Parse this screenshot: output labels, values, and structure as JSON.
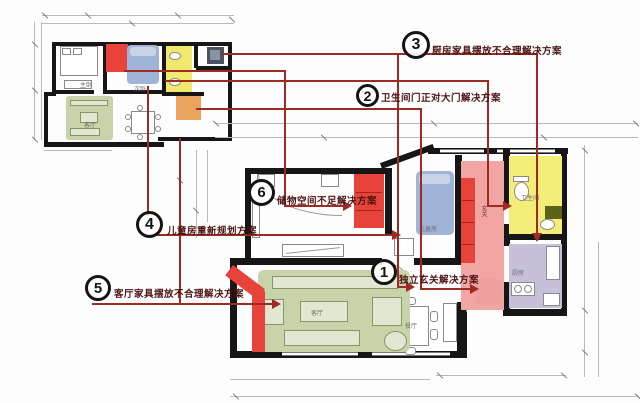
{
  "annotations": [
    {
      "num": "1",
      "label": "独立玄关解决方案"
    },
    {
      "num": "2",
      "label": "卫生间门正对大门解决方案"
    },
    {
      "num": "3",
      "label": "厨房家具摆放不合理解决方案"
    },
    {
      "num": "4",
      "label": "儿童房重新规划方案"
    },
    {
      "num": "5",
      "label": "客厅家具摆放不合理解决方案"
    },
    {
      "num": "6",
      "label": "储物空间不足解决方案"
    }
  ],
  "plan_large": {
    "rooms": {
      "children": "儿童房",
      "entry": "玄关",
      "bath": "卫生间",
      "kitchen": "厨房",
      "living": "客厅",
      "dining": "餐厅"
    }
  },
  "plan_small": {
    "rooms": {
      "master": "主卧",
      "second": "次卧",
      "living": "客厅"
    }
  },
  "colors": {
    "highlight_red": "#e8433b",
    "pink": "#f2a6a3",
    "blue": "#9fb4d6",
    "yellow": "#f4ee79",
    "orange": "#e8a45f",
    "green": "#c9d3aa",
    "purple": "#c6c0d8",
    "olive": "#5c6218",
    "connector_red": "#9e2b22"
  }
}
